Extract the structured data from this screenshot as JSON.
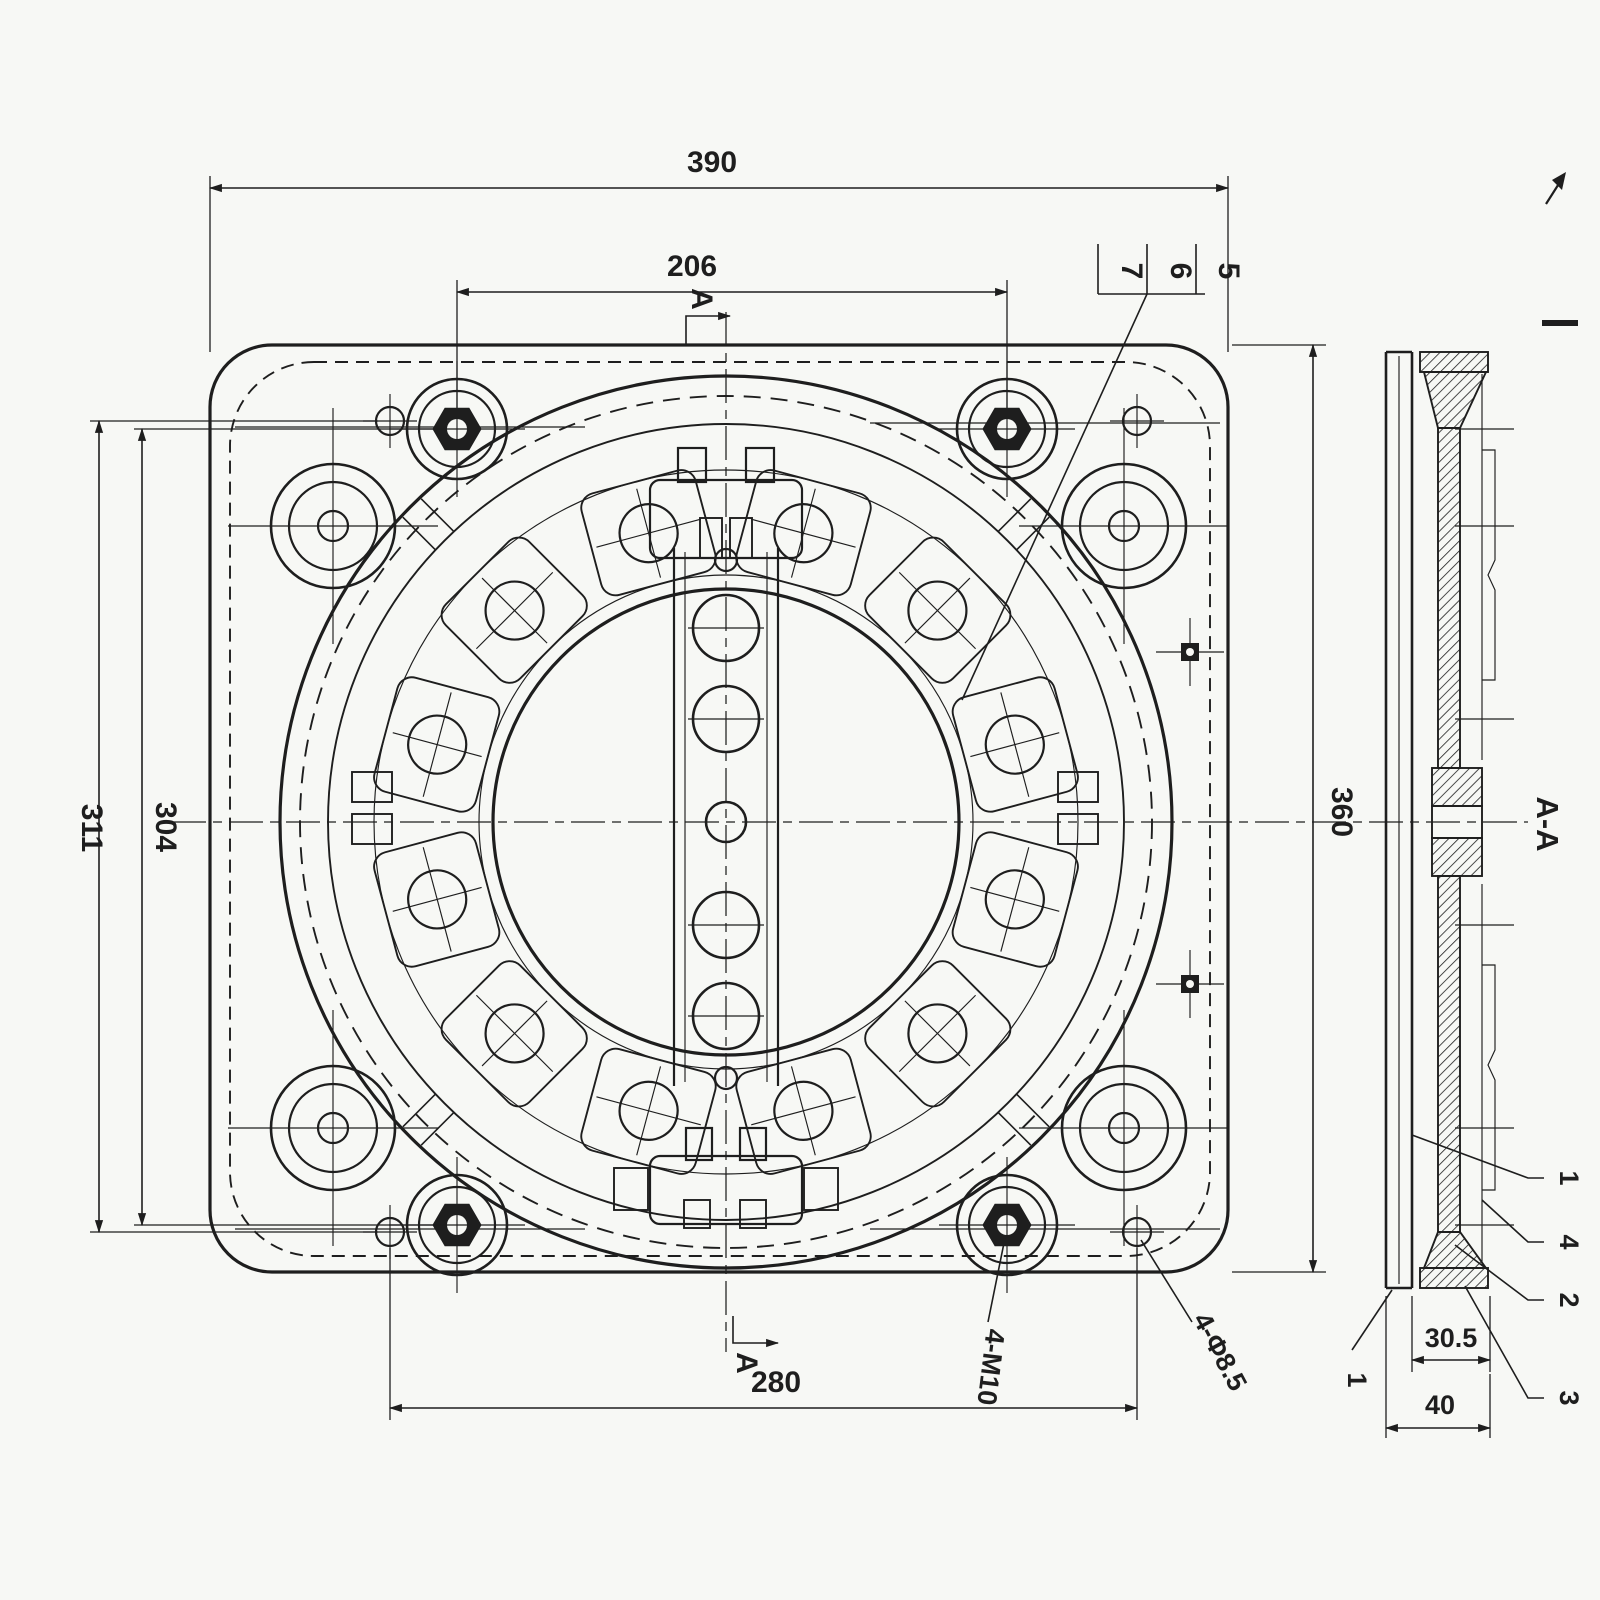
{
  "palette": {
    "ink": "#1e1e1e",
    "paper": "#f7f8f5"
  },
  "drawing": {
    "kind": "seat-swivel-base-engineering-drawing",
    "front_view": "front-view-of-swivel-plate",
    "side_view": "section-view"
  },
  "dimensions": {
    "overall_width": "390",
    "bolt_spacing_h": "206",
    "hole_spacing_v": "311",
    "bolt_spacing_v": "304",
    "overall_height": "360",
    "hole_spacing_h": "280",
    "seat_thickness": "30.5",
    "total_thickness": "40"
  },
  "callouts": {
    "thread_holes": "4-M10",
    "clearance_holes": "4-Φ8.5",
    "section_label": "A-A",
    "cut_letter_top": "A",
    "cut_letter_bottom": "A",
    "part_stack_left_to_right": [
      "7",
      "6",
      "5"
    ],
    "side_parts_top_to_bottom": [
      "1",
      "4",
      "2",
      "3"
    ],
    "side_part_lower_left": "1"
  }
}
